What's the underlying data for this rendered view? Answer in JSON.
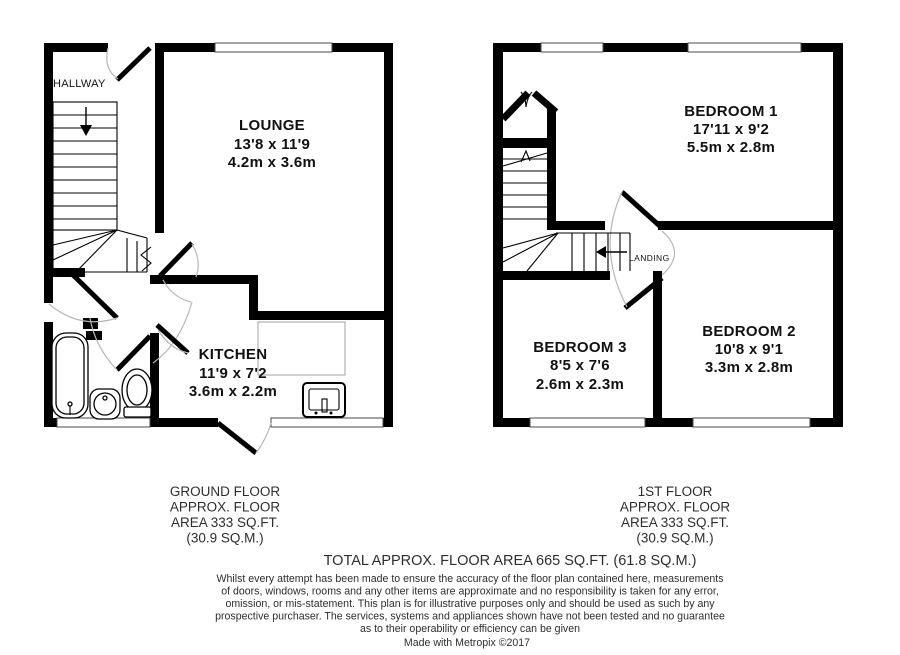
{
  "colors": {
    "wall": "#000000",
    "door_arc": "#b7b7b7",
    "room_text": "#111111",
    "caption_text": "#2e2e2e",
    "counter": "#b0b0b0"
  },
  "floors": {
    "ground": {
      "caption_lines": [
        "GROUND FLOOR",
        "APPROX. FLOOR",
        "AREA 333 SQ.FT.",
        "(30.9 SQ.M.)"
      ],
      "rooms": {
        "hallway": {
          "name": "HALLWAY"
        },
        "lounge": {
          "name": "LOUNGE",
          "size_imperial": "13'8 x 11'9",
          "size_metric": "4.2m x 3.6m"
        },
        "kitchen": {
          "name": "KITCHEN",
          "size_imperial": "11'9 x 7'2",
          "size_metric": "3.6m x 2.2m"
        }
      }
    },
    "first": {
      "caption_lines": [
        "1ST FLOOR",
        "APPROX. FLOOR",
        "AREA 333 SQ.FT.",
        "(30.9 SQ.M.)"
      ],
      "rooms": {
        "bedroom1": {
          "name": "BEDROOM 1",
          "size_imperial": "17'11 x 9'2",
          "size_metric": "5.5m x 2.8m"
        },
        "bedroom2": {
          "name": "BEDROOM 2",
          "size_imperial": "10'8 x 9'1",
          "size_metric": "3.3m x 2.8m"
        },
        "bedroom3": {
          "name": "BEDROOM 3",
          "size_imperial": "8'5 x 7'6",
          "size_metric": "2.6m x 2.3m"
        },
        "landing": {
          "name": "LANDING"
        }
      }
    }
  },
  "summary": {
    "total_line": "TOTAL APPROX. FLOOR AREA 665 SQ.FT. (61.8 SQ.M.)"
  },
  "disclaimer_lines": [
    "Whilst every attempt has been made to ensure the accuracy of the floor plan contained here, measurements",
    "of doors, windows, rooms and any other items are approximate and no responsibility is taken for any error,",
    "omission, or mis-statement. This plan is for illustrative purposes only and should be used as such by any",
    "prospective purchaser. The services, systems and appliances shown have not been tested and no guarantee",
    "as to their operability or efficiency can be given"
  ],
  "credit_line": "Made with Metropix ©2017"
}
